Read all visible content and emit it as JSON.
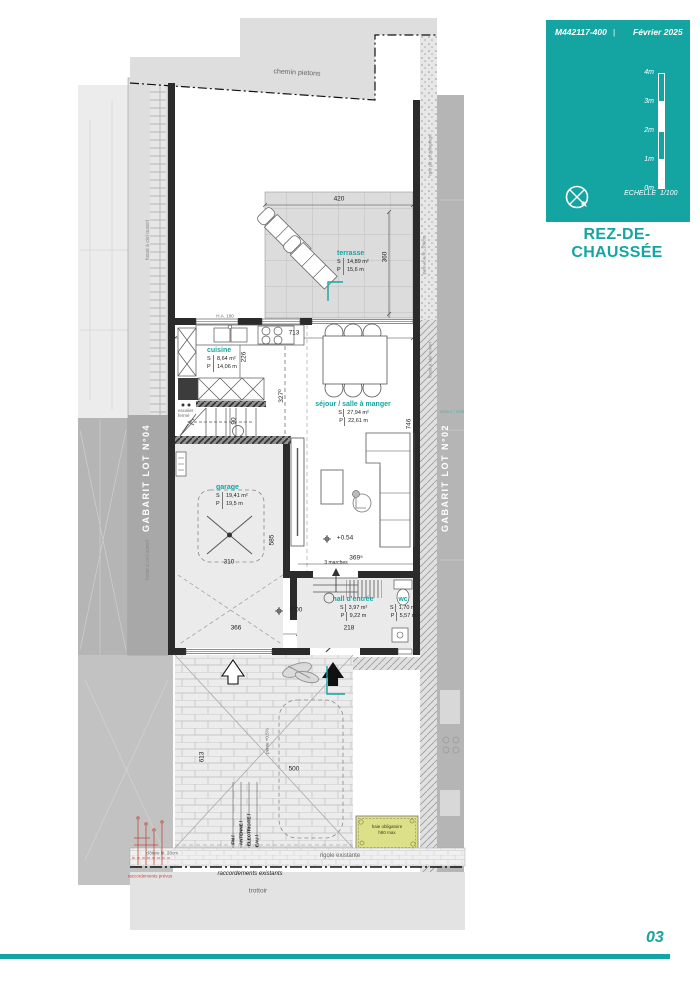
{
  "colors": {
    "accent": "#14A5A3",
    "wall": "#2B2B2B",
    "neighbor": "#B5B5B5",
    "path": "#DEDEDE",
    "hedge": "#DCE089",
    "red": "#C34A3E"
  },
  "legend": {
    "ref": "M442117-400",
    "sep": "|",
    "date": "Février 2025",
    "ticks": [
      "4m",
      "3m",
      "2m",
      "1m",
      "0m"
    ],
    "echelle_label": "ECHELLE",
    "echelle_value": "1/100",
    "title": "REZ-DE-CHAUSSÉE"
  },
  "page": {
    "number": "03"
  },
  "labels": {
    "s": "S",
    "p": "P"
  },
  "rooms": [
    {
      "name": "terrasse",
      "s": "14,89 m²",
      "p": "15,6 m"
    },
    {
      "name": "cuisine",
      "s": "8,64 m²",
      "p": "14,06 m"
    },
    {
      "name": "séjour / salle à manger",
      "s": "27,94 m²",
      "p": "22,61 m"
    },
    {
      "name": "garage",
      "s": "19,41 m²",
      "p": "19,5 m"
    },
    {
      "name": "hall d'entrée",
      "s": "3,97 m²",
      "p": "9,22 m"
    },
    {
      "name": "wc",
      "s": "1,70 m²",
      "p": "5,57 m"
    }
  ],
  "dims": {
    "terrace_w": "420",
    "terrace_d": "360",
    "house_w": "713",
    "kitchen_d": "226",
    "interior_d": "327⁰",
    "stair_w": "90",
    "sejour_d": "746",
    "garage_w": "310",
    "garage_d": "585",
    "garage_w2": "366",
    "hall_w": "369⁵",
    "hall_w2": "218",
    "drive_w": "500",
    "drive_d": "613"
  },
  "levels": {
    "hall": "0.00",
    "sejour": "+0.54",
    "steps": "3 marches"
  },
  "site": {
    "path": "chemin pietons",
    "sidewalk": "trottoir",
    "gutter": "rigole existante",
    "connections_existing": "raccordements existants",
    "connections_planned": "raccordements prévus",
    "fence": "clôture ht. 20cm",
    "hedge1": "haie obligatoire",
    "hedge2": "h80 max",
    "utilities": [
      "FM /",
      "ANTENNE /",
      "ELECTRICITE /",
      "EAU /"
    ],
    "gabarit_left": "GABARIT LOT N°04",
    "gabarit_right": "GABARIT LOT N°02",
    "ditch": "fossé à ciel ouvert",
    "retaining": "mur de soutènement",
    "screen": "pare-vue ht. 180cm",
    "slope": "pente +0,5%",
    "lintel": "H.A. 100",
    "stair_note": "escalier fermé"
  }
}
